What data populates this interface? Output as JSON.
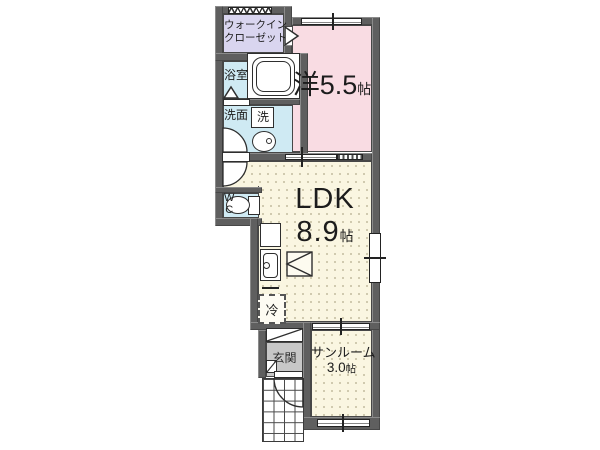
{
  "floorplan": {
    "rooms": {
      "wic": {
        "label_line1": "ウォークイン",
        "label_line2": "クローゼット"
      },
      "bath": {
        "label": "浴室"
      },
      "washroom": {
        "label": "洗面"
      },
      "washer": {
        "label": "洗"
      },
      "wc": {
        "label_w": "W",
        "label_c": "C"
      },
      "western": {
        "name": "洋",
        "size": "5.5",
        "unit": "帖"
      },
      "ldk": {
        "name": "LDK",
        "size": "8.9",
        "unit": "帖"
      },
      "fridge": {
        "label": "冷"
      },
      "entrance": {
        "label": "玄関"
      },
      "sunroom": {
        "name": "サンルーム",
        "size": "3.0",
        "unit": "帖"
      }
    },
    "colors": {
      "wall": "#5f5f5f",
      "wic_fill": "#d9d5ef",
      "wet_fill": "#cfeaf3",
      "western_fill": "#f9dce3",
      "ldk_fill": "#faf6e1",
      "entrance_fill": "#c7c7c7",
      "line": "#2e2e2e"
    }
  }
}
